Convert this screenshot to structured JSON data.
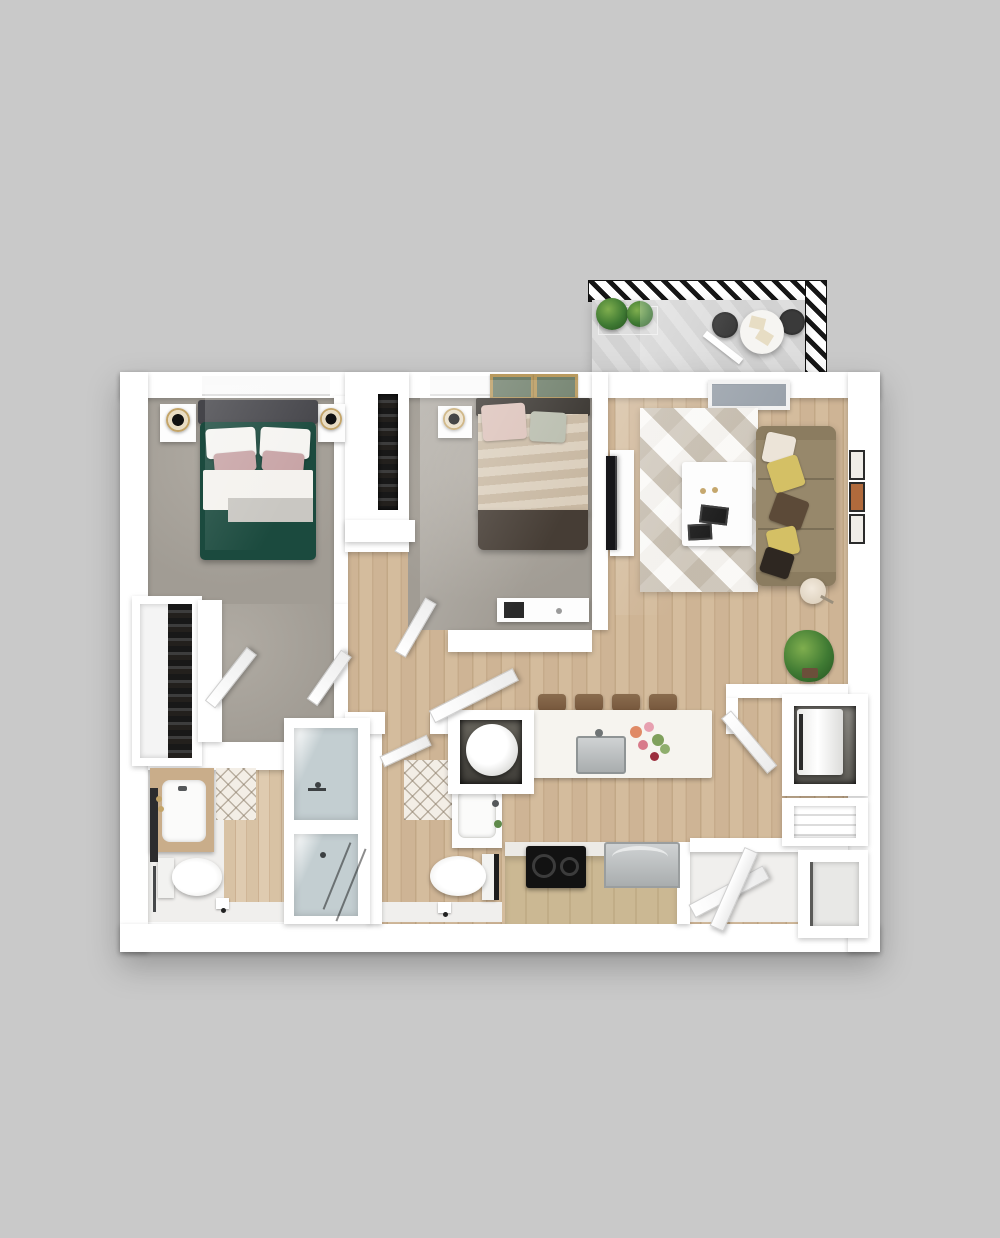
{
  "scene": {
    "type": "3d-floor-plan-render",
    "view": "top-down",
    "unit": "two-bedroom two-bath apartment with balcony",
    "visible_text": "none"
  },
  "palette": {
    "bg": "#c9c9c9",
    "wall": "#ffffff",
    "carpet": "#a19c94",
    "wood": "#ccb293",
    "deck": "#d2d2d2",
    "hatch": "#161616",
    "glass": "#c3ced1",
    "plant": "#3f7a33",
    "gold": "#c3a468",
    "stool": "#76573c",
    "green_duvet": "#1b4a3e",
    "sofa": "#97886b",
    "pillow_yellow": "#d4c065",
    "pillow_brown": "#5c4a38",
    "bed2_foot": "#463d35",
    "stove": "#121212"
  },
  "balcony": {
    "label": "Balcony",
    "items": [
      "hatched railing border",
      "plank deck",
      "two potted plants",
      "round bistro table",
      "two dark chairs",
      "two table mats"
    ]
  },
  "rooms": [
    {
      "name": "Bedroom 1",
      "floor": "carpet",
      "furniture": [
        "double bed with green duvet and blush pillows",
        "left nightstand with lamp",
        "right nightstand with lamp",
        "window"
      ]
    },
    {
      "name": "Walk-in Closet",
      "floor": "carpet",
      "furniture": [
        "hanging clothes rail"
      ]
    },
    {
      "name": "Bedroom 2",
      "floor": "carpet",
      "furniture": [
        "double bed with striped duvet",
        "nightstand with lamp",
        "two framed pictures",
        "media console",
        "reach-in closet"
      ]
    },
    {
      "name": "Living Room",
      "floor": "wood",
      "furniture": [
        "three-seat sofa with five throw pillows",
        "geometric area rug",
        "white coffee table with remotes",
        "TV with console",
        "three wall frames",
        "floor lamp",
        "potted plant",
        "sliding balcony door"
      ]
    },
    {
      "name": "Kitchen",
      "floor": "wood",
      "furniture": [
        "island with stainless sink and flowers",
        "four bar stools",
        "black cooktop",
        "stainless appliance",
        "tan base cabinets"
      ]
    },
    {
      "name": "Bathroom 1",
      "floor": "white + wood",
      "furniture": [
        "wood-top vanity with sink",
        "wall mirror",
        "toilet",
        "towel bar",
        "glass shower",
        "diamond tile mat",
        "paper holder"
      ]
    },
    {
      "name": "Bathroom 2",
      "floor": "wood",
      "furniture": [
        "white vanity with sink",
        "toilet",
        "glass shower",
        "diamond tile mat",
        "paper holder"
      ]
    },
    {
      "name": "Hallway",
      "floor": "wood",
      "furniture": [
        "open interior doors"
      ]
    },
    {
      "name": "Utility Closet",
      "furniture": [
        "round water heater"
      ]
    },
    {
      "name": "Laundry Closet",
      "furniture": [
        "white washer",
        "open door"
      ]
    },
    {
      "name": "Entry",
      "furniture": [
        "two open entry doors",
        "coat closet",
        "shelf niche"
      ]
    }
  ]
}
